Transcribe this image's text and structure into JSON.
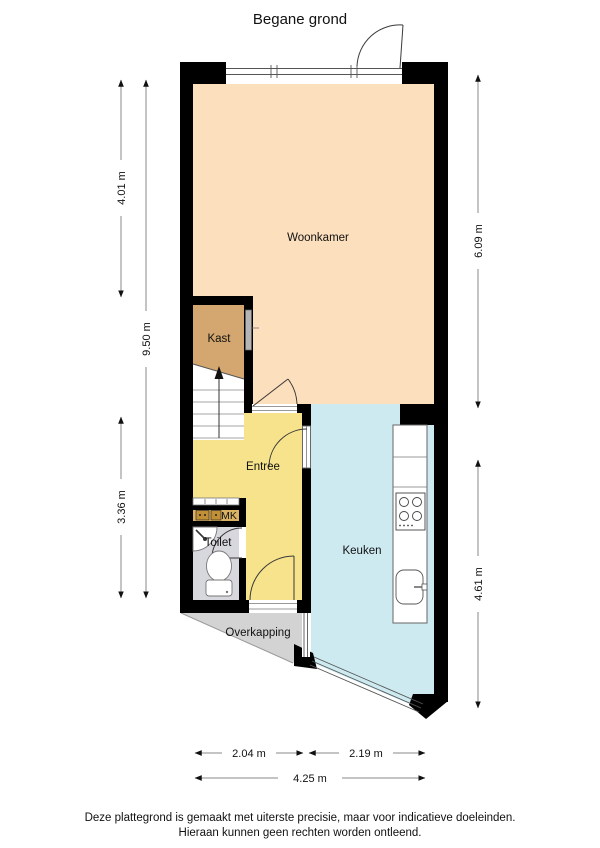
{
  "title": "Begane grond",
  "floor_plan": {
    "rooms": {
      "woonkamer": {
        "label": "Woonkamer",
        "color": "#fcdfbd"
      },
      "kast": {
        "label": "Kast",
        "color": "#d3a76f"
      },
      "entree": {
        "label": "Entree",
        "color": "#f6e38b"
      },
      "toilet": {
        "label": "Toilet",
        "color": "#d7d7de"
      },
      "meterkast": {
        "label": "MK",
        "color": "#d9b263"
      },
      "keuken": {
        "label": "Keuken",
        "color": "#cdeaf1"
      },
      "overkapping": {
        "label": "Overkapping",
        "color": "#d3d3d3"
      }
    },
    "dimensions": {
      "left_upper": "4.01 m",
      "left_total": "9.50 m",
      "left_lower": "3.36 m",
      "right_upper": "6.09 m",
      "right_lower": "4.61 m",
      "bottom_left": "2.04 m",
      "bottom_right": "2.19 m",
      "bottom_total": "4.25 m"
    }
  },
  "footer": {
    "line1": "Deze plattegrond is gemaakt met uiterste precisie, maar voor indicatieve doeleinden.",
    "line2": "Hieraan kunnen geen rechten worden ontleend."
  },
  "colors": {
    "wall": "#000000",
    "dimension_line": "#8a8a8a",
    "text": "#111111"
  }
}
